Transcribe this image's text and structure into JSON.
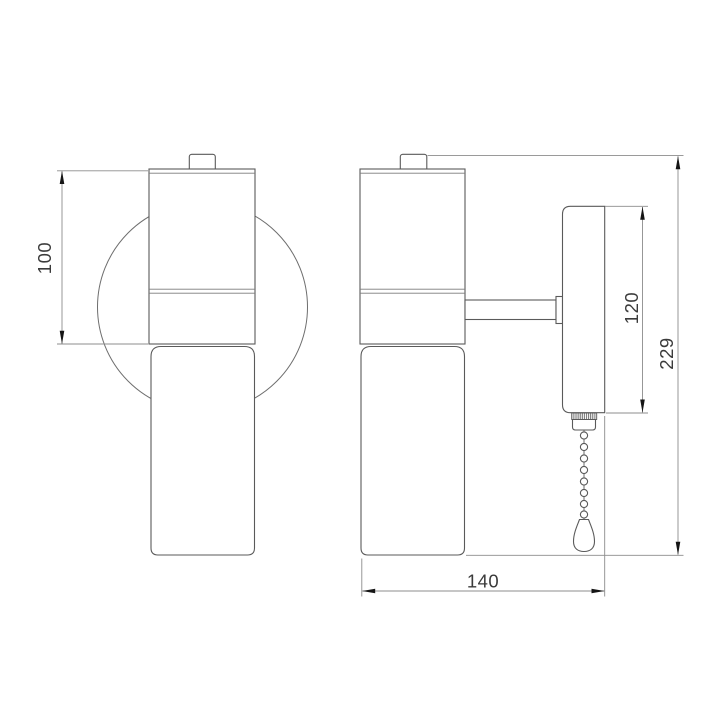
{
  "drawing": {
    "kind": "wall-sconce-dimension-drawing",
    "views": [
      "front",
      "side"
    ],
    "dimensions": {
      "front_body_height": "100",
      "backplate_height": "120",
      "overall_height": "229",
      "overall_depth": "140"
    },
    "colors": {
      "background": "#ffffff",
      "outline": "#5a5a5a",
      "dimension_line": "#8c8c8c",
      "arrow": "#151515",
      "text": "#3b3b3b"
    }
  }
}
